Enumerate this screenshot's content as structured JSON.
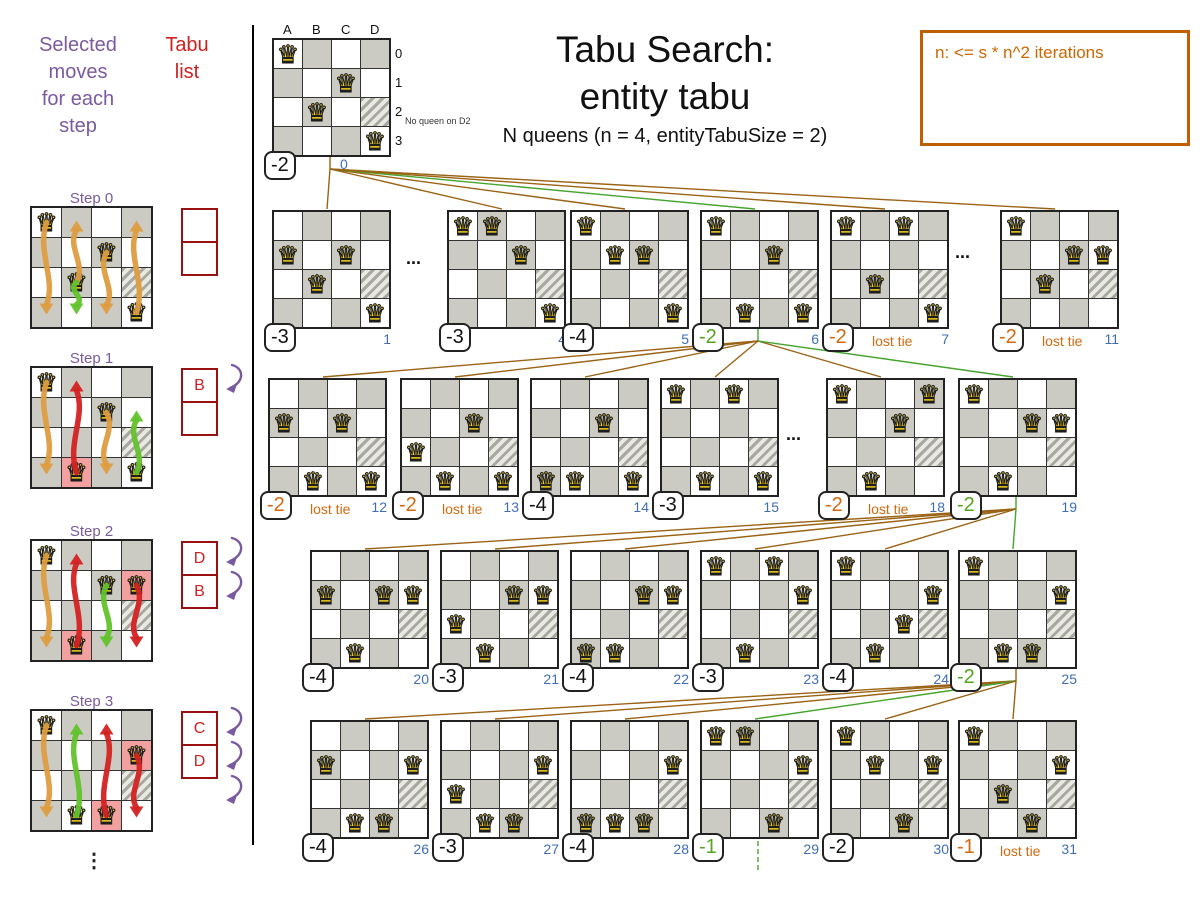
{
  "header": {
    "title_line1": "Tabu Search:",
    "title_line2": "entity tabu",
    "subtitle": "N queens (n = 4, entityTabuSize = 2)",
    "note": "n: <= s * n^2 iterations"
  },
  "left_panel": {
    "heading_lines": [
      "Selected",
      "moves",
      "for each",
      "step"
    ],
    "tabu_lines": [
      "Tabu",
      "list"
    ],
    "vertical_ellipsis": "⋮",
    "steps": [
      {
        "label": "Step 0",
        "queens": [
          "A0",
          "C1",
          "B2",
          "D3"
        ],
        "highlights": [],
        "tabu": [
          "",
          ""
        ],
        "tabu_arrows": 0,
        "arrows": [
          {
            "col": "A",
            "from": 0,
            "to": 3,
            "color": "orange"
          },
          {
            "col": "B",
            "from": 2,
            "to": 0,
            "color": "orange"
          },
          {
            "col": "C",
            "from": 1,
            "to": 3,
            "color": "orange"
          },
          {
            "col": "D",
            "from": 3,
            "to": 0,
            "color": "orange"
          },
          {
            "col": "B",
            "from": 2,
            "to": 3,
            "color": "green"
          }
        ]
      },
      {
        "label": "Step 1",
        "queens": [
          "A0",
          "C1",
          "B3",
          "D3"
        ],
        "highlights": [
          "B3"
        ],
        "tabu": [
          "B",
          ""
        ],
        "tabu_arrows": 1,
        "arrows": [
          {
            "col": "A",
            "from": 0,
            "to": 3,
            "color": "orange"
          },
          {
            "col": "C",
            "from": 1,
            "to": 3,
            "color": "orange"
          },
          {
            "col": "B",
            "from": 3,
            "to": 0,
            "color": "red"
          },
          {
            "col": "D",
            "from": 3,
            "to": 1,
            "color": "green"
          }
        ]
      },
      {
        "label": "Step 2",
        "queens": [
          "A0",
          "C1",
          "D1",
          "B3"
        ],
        "highlights": [
          "D1",
          "B3"
        ],
        "tabu": [
          "D",
          "B"
        ],
        "tabu_arrows": 2,
        "arrows": [
          {
            "col": "A",
            "from": 0,
            "to": 3,
            "color": "orange"
          },
          {
            "col": "B",
            "from": 3,
            "to": 0,
            "color": "red"
          },
          {
            "col": "C",
            "from": 1,
            "to": 3,
            "color": "green"
          },
          {
            "col": "D",
            "from": 1,
            "to": 3,
            "color": "red"
          }
        ]
      },
      {
        "label": "Step 3",
        "queens": [
          "A0",
          "D1",
          "B3",
          "C3"
        ],
        "highlights": [
          "D1",
          "C3"
        ],
        "tabu": [
          "C",
          "D"
        ],
        "tabu_arrows": 3,
        "arrows": [
          {
            "col": "A",
            "from": 0,
            "to": 3,
            "color": "orange"
          },
          {
            "col": "B",
            "from": 3,
            "to": 0,
            "color": "green"
          },
          {
            "col": "C",
            "from": 3,
            "to": 0,
            "color": "red"
          },
          {
            "col": "D",
            "from": 1,
            "to": 3,
            "color": "red"
          }
        ]
      }
    ]
  },
  "top_board": {
    "id": 0,
    "score": "-2",
    "index": "0",
    "queens": [
      "A0",
      "C1",
      "B2",
      "D3"
    ],
    "col_labels": [
      "A",
      "B",
      "C",
      "D"
    ],
    "row_labels": [
      "0",
      "1",
      "2",
      "3"
    ],
    "annotation": "No queen on D2"
  },
  "boards": [
    {
      "id": 1,
      "row": 1,
      "score": "-3",
      "kind": "normal",
      "queens": [
        "A1",
        "C1",
        "B2",
        "D3"
      ]
    },
    {
      "id": 4,
      "row": 1,
      "score": "-3",
      "kind": "normal",
      "queens": [
        "A0",
        "B0",
        "C1",
        "D3"
      ]
    },
    {
      "id": 5,
      "row": 1,
      "score": "-4",
      "kind": "normal",
      "queens": [
        "A0",
        "B1",
        "C1",
        "D3"
      ]
    },
    {
      "id": 6,
      "row": 1,
      "score": "-2",
      "kind": "selected",
      "queens": [
        "A0",
        "C1",
        "B3",
        "D3"
      ]
    },
    {
      "id": 7,
      "row": 1,
      "score": "-2",
      "kind": "lost",
      "note": "lost tie",
      "queens": [
        "A0",
        "C0",
        "B2",
        "D3"
      ]
    },
    {
      "id": 11,
      "row": 1,
      "score": "-2",
      "kind": "lost",
      "note": "lost tie",
      "queens": [
        "A0",
        "C1",
        "D1",
        "B2"
      ]
    },
    {
      "id": 12,
      "row": 2,
      "score": "-2",
      "kind": "lost",
      "note": "lost tie",
      "queens": [
        "A1",
        "C1",
        "B3",
        "D3"
      ]
    },
    {
      "id": 13,
      "row": 2,
      "score": "-2",
      "kind": "lost",
      "note": "lost tie",
      "queens": [
        "C1",
        "A2",
        "B3",
        "D3"
      ]
    },
    {
      "id": 14,
      "row": 2,
      "score": "-4",
      "kind": "normal",
      "queens": [
        "C1",
        "A3",
        "B3",
        "D3"
      ]
    },
    {
      "id": 15,
      "row": 2,
      "score": "-3",
      "kind": "normal",
      "queens": [
        "A0",
        "C0",
        "B3",
        "D3"
      ]
    },
    {
      "id": 18,
      "row": 2,
      "score": "-2",
      "kind": "lost",
      "note": "lost tie",
      "queens": [
        "A0",
        "D0",
        "C1",
        "B3"
      ]
    },
    {
      "id": 19,
      "row": 2,
      "score": "-2",
      "kind": "selected",
      "queens": [
        "A0",
        "C1",
        "D1",
        "B3"
      ]
    },
    {
      "id": 20,
      "row": 3,
      "score": "-4",
      "kind": "normal",
      "queens": [
        "A1",
        "C1",
        "D1",
        "B3"
      ]
    },
    {
      "id": 21,
      "row": 3,
      "score": "-3",
      "kind": "normal",
      "queens": [
        "C1",
        "D1",
        "A2",
        "B3"
      ]
    },
    {
      "id": 22,
      "row": 3,
      "score": "-4",
      "kind": "normal",
      "queens": [
        "C1",
        "D1",
        "A3",
        "B3"
      ]
    },
    {
      "id": 23,
      "row": 3,
      "score": "-3",
      "kind": "normal",
      "queens": [
        "A0",
        "C0",
        "D1",
        "B3"
      ]
    },
    {
      "id": 24,
      "row": 3,
      "score": "-4",
      "kind": "normal",
      "queens": [
        "A0",
        "D1",
        "C2",
        "B3"
      ]
    },
    {
      "id": 25,
      "row": 3,
      "score": "-2",
      "kind": "selected",
      "queens": [
        "A0",
        "D1",
        "B3",
        "C3"
      ]
    },
    {
      "id": 26,
      "row": 4,
      "score": "-4",
      "kind": "normal",
      "queens": [
        "A1",
        "D1",
        "B3",
        "C3"
      ]
    },
    {
      "id": 27,
      "row": 4,
      "score": "-3",
      "kind": "normal",
      "queens": [
        "D1",
        "A2",
        "B3",
        "C3"
      ]
    },
    {
      "id": 28,
      "row": 4,
      "score": "-4",
      "kind": "normal",
      "queens": [
        "D1",
        "A3",
        "B3",
        "C3"
      ]
    },
    {
      "id": 29,
      "row": 4,
      "score": "-1",
      "kind": "selected",
      "queens": [
        "A0",
        "B0",
        "D1",
        "C3"
      ]
    },
    {
      "id": 30,
      "row": 4,
      "score": "-2",
      "kind": "normal",
      "queens": [
        "A0",
        "B1",
        "D1",
        "C3"
      ]
    },
    {
      "id": 31,
      "row": 4,
      "score": "-1",
      "kind": "lost",
      "note": "lost tie",
      "queens": [
        "A0",
        "D1",
        "B2",
        "C3"
      ]
    }
  ],
  "ellipsis_dots": "...",
  "connections": [
    {
      "from": 0,
      "to": 1
    },
    {
      "from": 0,
      "to": 4
    },
    {
      "from": 0,
      "to": 5
    },
    {
      "from": 0,
      "to": 6,
      "selected": true
    },
    {
      "from": 0,
      "to": 7
    },
    {
      "from": 0,
      "to": 11
    },
    {
      "from": 6,
      "to": 12
    },
    {
      "from": 6,
      "to": 13
    },
    {
      "from": 6,
      "to": 14
    },
    {
      "from": 6,
      "to": 15
    },
    {
      "from": 6,
      "to": 18
    },
    {
      "from": 6,
      "to": 19,
      "selected": true
    },
    {
      "from": 19,
      "to": 20
    },
    {
      "from": 19,
      "to": 21
    },
    {
      "from": 19,
      "to": 22
    },
    {
      "from": 19,
      "to": 23
    },
    {
      "from": 19,
      "to": 24
    },
    {
      "from": 19,
      "to": 25,
      "selected": true
    },
    {
      "from": 25,
      "to": 26
    },
    {
      "from": 25,
      "to": 27
    },
    {
      "from": 25,
      "to": 28
    },
    {
      "from": 25,
      "to": 29,
      "selected": true
    },
    {
      "from": 25,
      "to": 30
    },
    {
      "from": 25,
      "to": 31
    },
    {
      "from": 29,
      "continuation": true
    }
  ],
  "colors": {
    "purple": "#7a5a9f",
    "red": "#cc2222",
    "tabu_border": "#991111",
    "line_brown": "#9a6315",
    "line_green": "#46a42e",
    "index_blue": "#3f6db8",
    "score_orange": "#d2690f",
    "score_green": "#55a320",
    "note_orange": "#cc6600",
    "arrow_orange": "#dd9c40",
    "arrow_red": "#d32222",
    "arrow_green": "#62c22c"
  }
}
